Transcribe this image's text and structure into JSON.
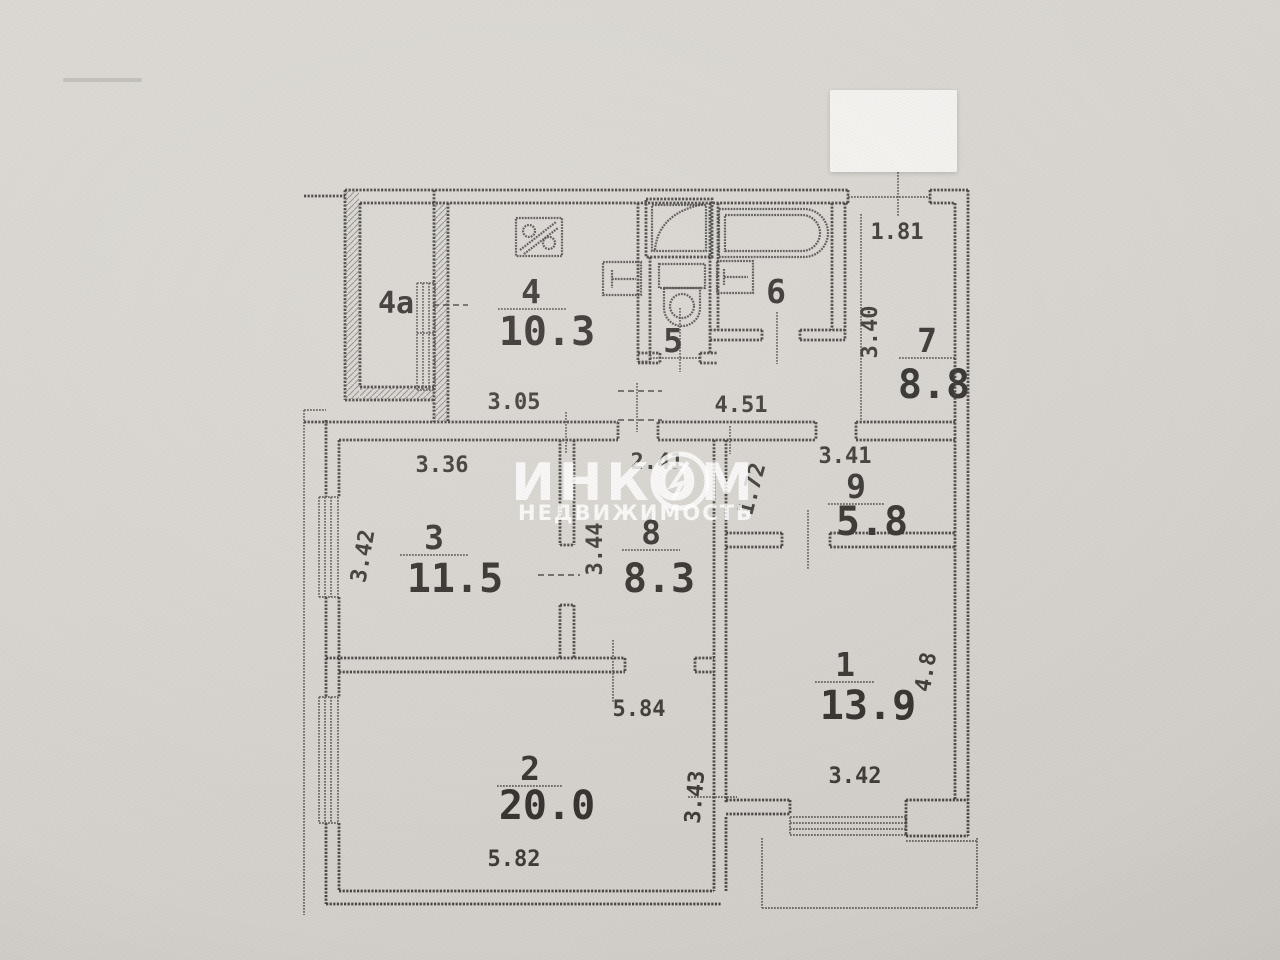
{
  "watermark": {
    "brand": "ИНКОМ",
    "subtitle": "НЕДВИЖИМОСТЬ"
  },
  "rooms": {
    "r1": {
      "number": "1",
      "area": "13.9"
    },
    "r2": {
      "number": "2",
      "area": "20.0"
    },
    "r3": {
      "number": "3",
      "area": "11.5"
    },
    "r4": {
      "number": "4",
      "area": "10.3"
    },
    "r4a": {
      "number": "4а"
    },
    "r5": {
      "number": "5"
    },
    "r6": {
      "number": "6"
    },
    "r7": {
      "number": "7",
      "area": "8.8"
    },
    "r8": {
      "number": "8",
      "area": "8.3"
    },
    "r9": {
      "number": "9",
      "area": "5.8"
    }
  },
  "dims": {
    "d305": "3.05",
    "d451": "4.51",
    "d181": "1.81",
    "d340": "3.40",
    "d336": "3.36",
    "d241": "2.41",
    "d341": "3.41",
    "d342l": "3.42",
    "d344": "3.44",
    "d172": "1.72",
    "d584": "5.84",
    "d343": "3.43",
    "d582": "5.82",
    "d342b": "3.42",
    "d48": "4.8"
  },
  "colors": {
    "paper": "#d7d3ce",
    "ink": "#3e3c38",
    "sticker": "#f3f2ef",
    "watermark": "#ffffff"
  }
}
